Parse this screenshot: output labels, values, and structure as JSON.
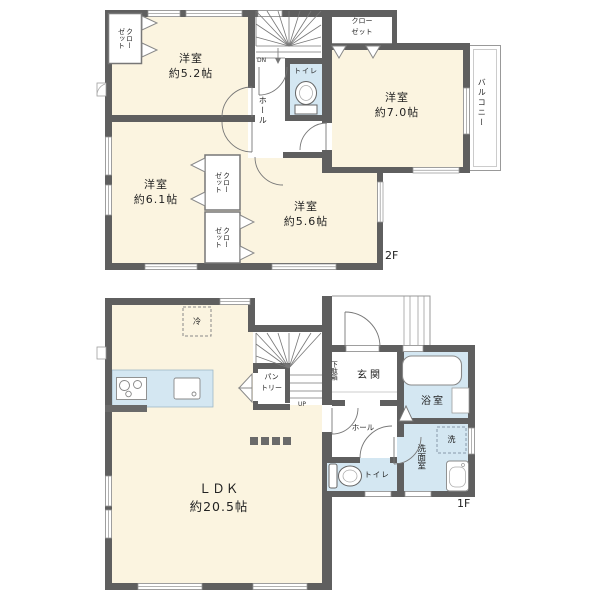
{
  "floor2": {
    "floor_label": "2F",
    "bedroom_52": "洋室\n約5.2帖",
    "bedroom_70": "洋室\n約7.0帖",
    "bedroom_61": "洋室\n約6.1帖",
    "bedroom_56": "洋室\n約5.6帖",
    "closet_top_left": "クロー\nゼット",
    "closet_top_right": "クロー\nゼット",
    "closet_mid_upper": "クロー\nゼット",
    "closet_mid_lower": "クロー\nゼット",
    "toilet": "トイレ",
    "hall": "ホール",
    "balcony": "バルコニー",
    "stairs_down": "DN"
  },
  "floor1": {
    "floor_label": "1F",
    "ldk": "ＬＤＫ\n約20.5帖",
    "entrance": "玄関",
    "shoe_cabinet": "下駄箱",
    "bath": "浴室",
    "washroom": "洗面室",
    "toilet": "トイレ",
    "hall": "ホール",
    "pantry": "パン\nトリー",
    "refrigerator": "冷",
    "washing_machine": "洗",
    "stairs_up": "UP"
  },
  "colors": {
    "wall": "#5f5f5f",
    "room_floor": "#fbf4e0",
    "wet_area": "#d4e7f2",
    "outline": "#999999"
  }
}
